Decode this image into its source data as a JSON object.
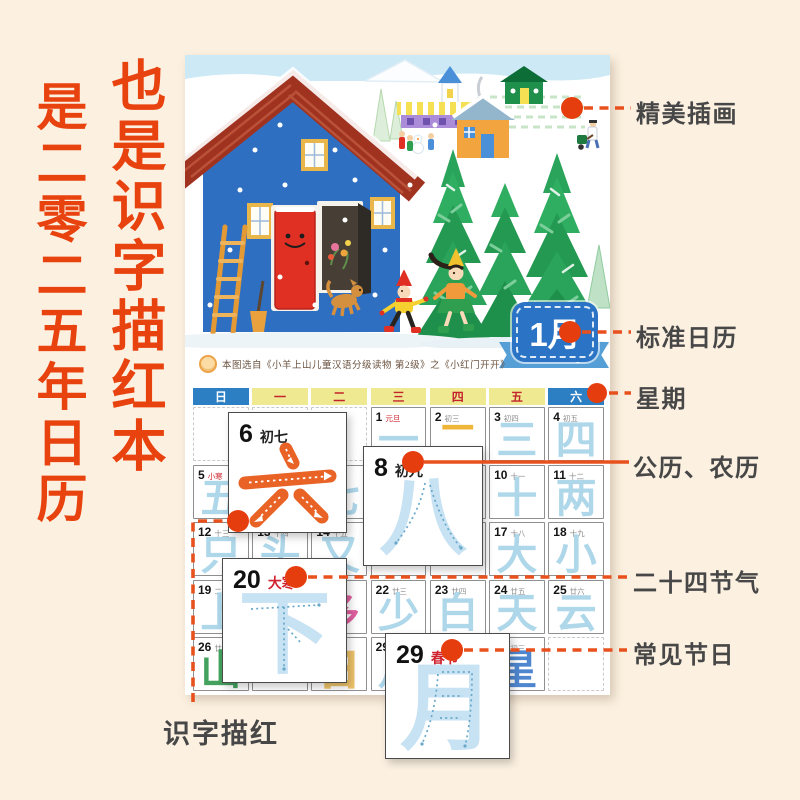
{
  "page": {
    "background": "#fcf1e1"
  },
  "headline": {
    "right_column": "也是识字描红本",
    "left_column": "是二零二五年日历",
    "color": "#e8420f"
  },
  "illustration_note": "winter scene: blue house with red roof and smiling red door, ladder, dog, two children, fir trees, village houses, snow",
  "month_badge": {
    "month": "1月",
    "month_en": "January"
  },
  "source_note": "本图选自《小羊上山儿童汉语分级读物 第2级》之《小红门开开》",
  "weekdays": [
    {
      "label": "日",
      "style": "blue"
    },
    {
      "label": "一",
      "style": "yellow"
    },
    {
      "label": "二",
      "style": "yellow"
    },
    {
      "label": "三",
      "style": "yellow"
    },
    {
      "label": "四",
      "style": "yellow"
    },
    {
      "label": "五",
      "style": "yellow"
    },
    {
      "label": "六",
      "style": "blue"
    }
  ],
  "calendar_rows": [
    [
      {
        "empty": true
      },
      {
        "empty": true
      },
      {
        "empty": true
      },
      {
        "day": "1",
        "lunar": "元旦",
        "lunar_red": true,
        "char": "一",
        "char_color": "blue"
      },
      {
        "day": "2",
        "lunar": "初三",
        "char": "二",
        "char_color": "yellow"
      },
      {
        "day": "3",
        "lunar": "初四",
        "char": "三",
        "char_color": "blue"
      },
      {
        "day": "4",
        "lunar": "初五",
        "char": "四",
        "char_color": "blue"
      }
    ],
    [
      {
        "day": "5",
        "lunar": "小寒",
        "lunar_red": true,
        "char": "五",
        "char_color": "blue"
      },
      {
        "day": "6",
        "lunar": "初七",
        "char": "六",
        "char_color": "blue"
      },
      {
        "day": "7",
        "lunar": "初八",
        "char": "七",
        "char_color": "blue"
      },
      {
        "day": "8",
        "lunar": "初九",
        "char": "八",
        "char_color": "blue"
      },
      {
        "day": "9",
        "lunar": "初十",
        "char": "九",
        "char_color": "blue"
      },
      {
        "day": "10",
        "lunar": "十一",
        "char": "十",
        "char_color": "blue"
      },
      {
        "day": "11",
        "lunar": "十二",
        "char": "两",
        "char_color": "blue"
      }
    ],
    [
      {
        "day": "12",
        "lunar": "十三",
        "char": "只",
        "char_color": "blue"
      },
      {
        "day": "13",
        "lunar": "十四",
        "char": "头",
        "char_color": "blue"
      },
      {
        "day": "14",
        "lunar": "十五",
        "char": "又",
        "char_color": "blue"
      },
      {
        "day": "15",
        "lunar": "十六",
        "char": "",
        "char_color": "blue"
      },
      {
        "day": "16",
        "lunar": "十七",
        "char": "",
        "char_color": "blue"
      },
      {
        "day": "17",
        "lunar": "十八",
        "char": "大",
        "char_color": "blue"
      },
      {
        "day": "18",
        "lunar": "十九",
        "char": "小",
        "char_color": "blue"
      }
    ],
    [
      {
        "day": "19",
        "lunar": "二十",
        "char": "上",
        "char_color": "blue"
      },
      {
        "day": "20",
        "lunar": "大寒",
        "lunar_red": true,
        "char": "下",
        "char_color": "blue"
      },
      {
        "day": "21",
        "lunar": "廿二",
        "char": "多",
        "char_color": "pink"
      },
      {
        "day": "22",
        "lunar": "廿三",
        "char": "少",
        "char_color": "blue"
      },
      {
        "day": "23",
        "lunar": "廿四",
        "char": "白",
        "char_color": "blue"
      },
      {
        "day": "24",
        "lunar": "廿五",
        "char": "天",
        "char_color": "blue"
      },
      {
        "day": "25",
        "lunar": "廿六",
        "char": "云",
        "char_color": "blue"
      }
    ],
    [
      {
        "day": "26",
        "lunar": "廿七",
        "char": "山",
        "char_color": "green"
      },
      {
        "day": "27",
        "lunar": "",
        "char": "",
        "char_color": "blue"
      },
      {
        "day": "28",
        "lunar": "除夕",
        "lunar_red": true,
        "char": "日",
        "char_color": "outline"
      },
      {
        "day": "29",
        "lunar": "春节",
        "lunar_red": true,
        "char": "月",
        "char_color": "blue"
      },
      {
        "day": "30",
        "lunar": "",
        "char": "",
        "char_color": "blue"
      },
      {
        "day": "31",
        "lunar": "初三",
        "char": "星",
        "char_color": "navy"
      },
      {
        "empty": true
      }
    ]
  ],
  "callouts": {
    "c6": {
      "day": "6",
      "label": "初七",
      "char": "六"
    },
    "c8": {
      "day": "8",
      "label": "初九",
      "char": "八"
    },
    "c20": {
      "day": "20",
      "label": "大寒",
      "char": "下"
    },
    "c29": {
      "day": "29",
      "label": "春节",
      "char": "月"
    }
  },
  "annotations": {
    "illustration": "精美插画",
    "calendar": "标准日历",
    "week": "星期",
    "dates": "公历、农历",
    "solar_terms": "二十四节气",
    "festivals": "常见节日",
    "tracing": "识字描红"
  },
  "colors": {
    "accent_red": "#e8420f",
    "week_blue": "#2d7fc4",
    "week_yellow": "#efe992",
    "trace_blue": "#aed7ea",
    "trace_orange": "#e96326",
    "badge_blue": "#2b74c5",
    "ribbon_blue": "#569fd6"
  }
}
